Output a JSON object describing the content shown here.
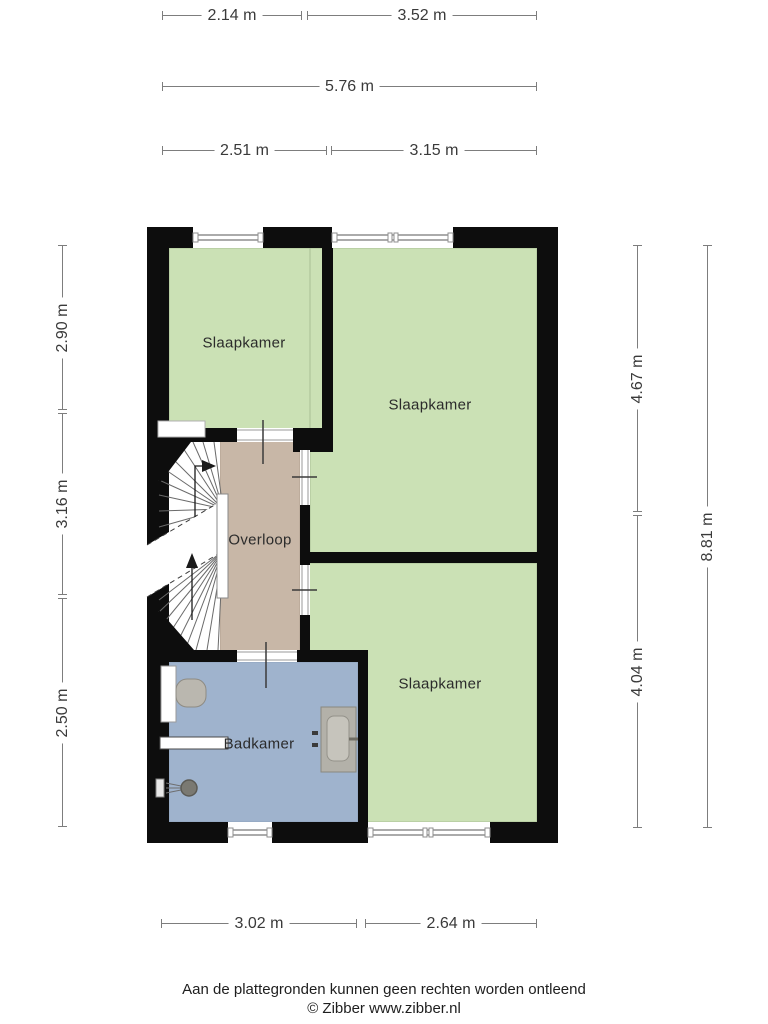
{
  "floorplan": {
    "rooms": {
      "slaapkamer_tl": "Slaapkamer",
      "slaapkamer_tr": "Slaapkamer",
      "slaapkamer_br": "Slaapkamer",
      "overloop": "Overloop",
      "badkamer": "Badkamer"
    },
    "colors": {
      "wall": "#0d0d0d",
      "bedroom_fill": "#cbe1b5",
      "landing_fill": "#c8b7a7",
      "bathroom_fill": "#9fb3cd"
    },
    "dimensions": {
      "top_row1_left": "2.14 m",
      "top_row1_right": "3.52 m",
      "top_row2_total": "5.76 m",
      "top_row3_left": "2.51 m",
      "top_row3_right": "3.15 m",
      "left_top": "2.90 m",
      "left_middle": "3.16 m",
      "left_bottom": "2.50 m",
      "right_top": "4.67 m",
      "right_bottom": "4.04 m",
      "right_total": "8.81 m",
      "bottom_left": "3.02 m",
      "bottom_right": "2.64 m"
    }
  },
  "footer": {
    "disclaimer": "Aan de plattegronden kunnen geen rechten worden ontleend",
    "credit": "© Zibber www.zibber.nl"
  }
}
